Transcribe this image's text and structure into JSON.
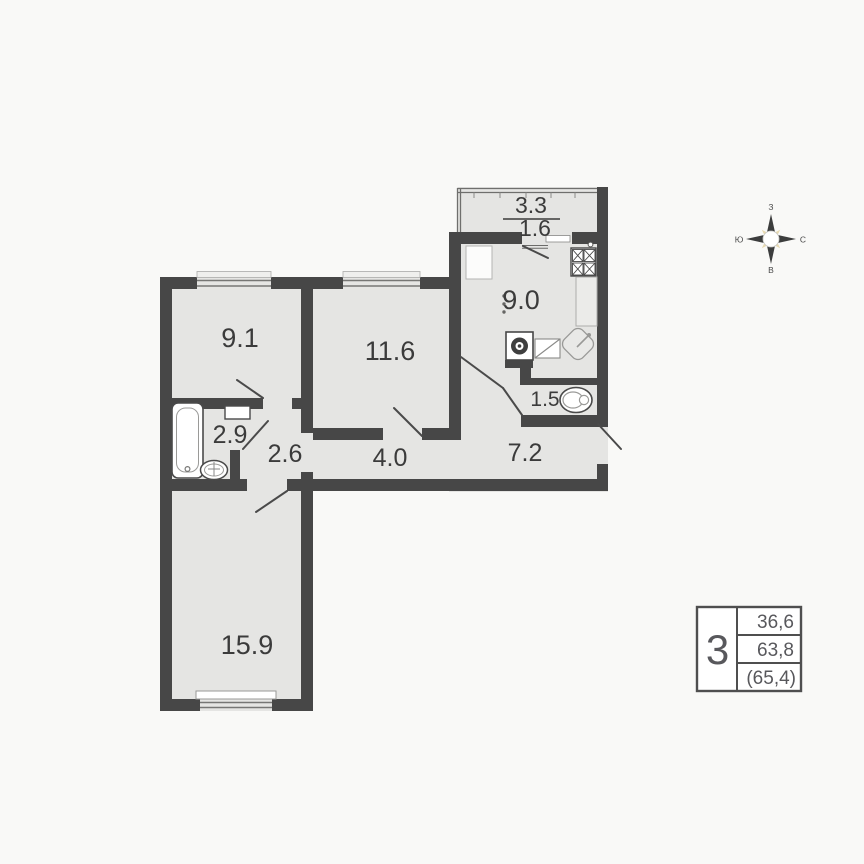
{
  "plan": {
    "balcony_area": "3.3",
    "balcony_area_reduced": "1.6",
    "kitchen_area": "9.0",
    "bedroom1_area": "9.1",
    "bedroom2_area": "11.6",
    "bathroom_area": "2.9",
    "hall_small_area": "2.6",
    "corridor_area": "4.0",
    "hallway_area": "7.2",
    "wc_area": "1.5",
    "living_room_area": "15.9"
  },
  "compass": {
    "top": "З",
    "right": "С",
    "bottom": "В",
    "left": "Ю"
  },
  "summary": {
    "rooms_count": "3",
    "living_area": "36,6",
    "total_area": "63,8",
    "total_area_with_balcony": "(65,4)"
  },
  "colors": {
    "wall": "#474747",
    "room_fill": "#e5e5e3",
    "compass_ray": "#e7d9b0"
  }
}
